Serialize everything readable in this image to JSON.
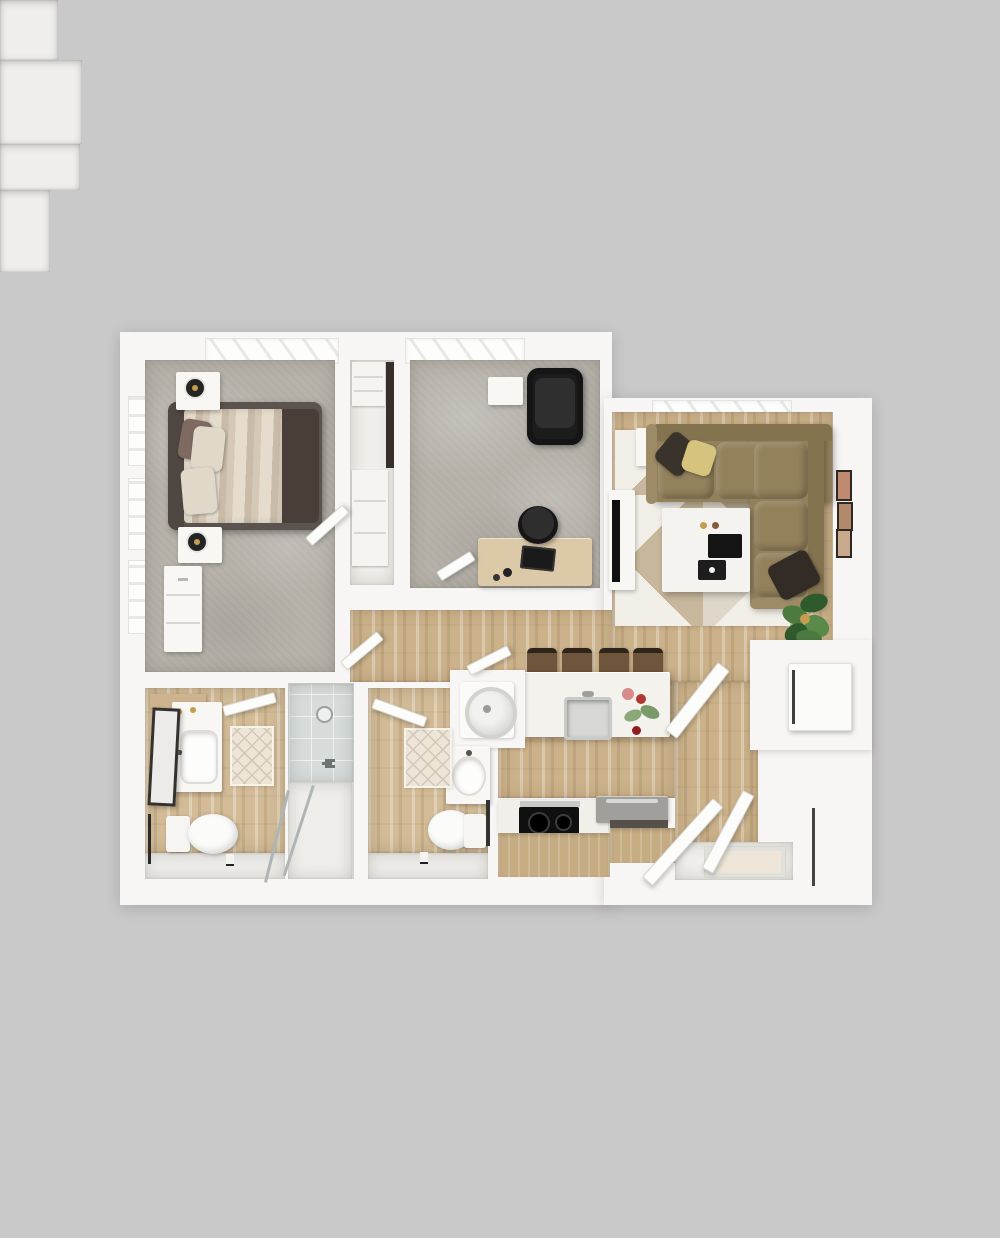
{
  "scene": {
    "type": "3d-floor-plan-top-view",
    "description": "Rendered top-down 3D floor plan of a one-bedroom apartment with den, two bathrooms, open kitchen-living area, laundry alcove and closets",
    "background_color": "#c9c9c9"
  },
  "palette": {
    "bg": "#c9c9c9",
    "wall": "#f7f6f4",
    "carpet": "#b7b3ab",
    "wood": "#ccb28a",
    "wood_bath": "#d2bb96",
    "tile": "#d7dcdb",
    "floor_white": "#efeeeb",
    "sofa": "#93815c",
    "sofa_light": "#9c8b66",
    "sofa_dark": "#84734f",
    "rug_base": "#ded6c8",
    "rug_light": "#f2efe8",
    "rug_tan": "#c7b79c",
    "rug_gray": "#b5a88f",
    "cabinet": "#c6ac83",
    "island": "#f4f2ed",
    "counter": "#f1efe9",
    "steel": "#c9cbc8",
    "black": "#1b1b1b",
    "bed_frame": "#5b534d",
    "bed_band": "#4a3f38",
    "duvet": "#e5dccd",
    "duvet_stripe": "#c9bba8",
    "pillow": "#e0d8c9",
    "pillow_accent": "#7e6a60",
    "desk_wood": "#dcc9a8",
    "stool": "#6f553b",
    "green": "#4c7a3f",
    "green_dark": "#2f5a2c",
    "gold": "#c59d4e",
    "mat": "#ece5d8",
    "mat_line": "#d4c9b8",
    "appliance_gray": "#a19f9b",
    "glass": "#aeb6b5"
  },
  "rooms": [
    {
      "id": "bedroom",
      "floor": "carpet"
    },
    {
      "id": "bedroom-closet",
      "floor": "white"
    },
    {
      "id": "office-den",
      "floor": "carpet"
    },
    {
      "id": "living-room",
      "floor": "wood"
    },
    {
      "id": "hallway",
      "floor": "wood"
    },
    {
      "id": "kitchen",
      "floor": "wood"
    },
    {
      "id": "bathroom-1",
      "floor": "wood"
    },
    {
      "id": "walk-in-shower",
      "floor": "tile"
    },
    {
      "id": "bathroom-2",
      "floor": "wood"
    },
    {
      "id": "laundry-alcove",
      "floor": "white"
    },
    {
      "id": "utility-closet",
      "floor": "white"
    },
    {
      "id": "linen-closet",
      "floor": "white"
    },
    {
      "id": "entry",
      "floor": "white"
    }
  ],
  "furniture": {
    "bedroom": [
      "queen-bed",
      "headboard",
      "striped-duvet",
      "pillows",
      "nightstand-top",
      "nightstand-bottom",
      "table-lamp-top",
      "table-lamp-bottom",
      "dresser"
    ],
    "bedroom_closet": [
      "shelf-unit-top",
      "shelf-unit-bottom",
      "hanging-clothes"
    ],
    "office_den": [
      "lounge-chair",
      "side-table",
      "desk",
      "laptop",
      "office-chair"
    ],
    "living_room": [
      "sectional-sofa",
      "throw-pillow-dark",
      "throw-pillow-yellow",
      "throw-pillow-chaise",
      "coffee-table",
      "serving-tray",
      "book",
      "tv-console",
      "tv",
      "area-rug",
      "side-table",
      "potted-plant",
      "wall-art-1",
      "wall-art-2",
      "wall-art-3"
    ],
    "kitchen": [
      "island",
      "bar-stool-1",
      "bar-stool-2",
      "bar-stool-3",
      "bar-stool-4",
      "undermount-sink",
      "faucet",
      "flower-arrangement",
      "cooktop",
      "range-oven",
      "base-cabinets"
    ],
    "bathroom_1": [
      "vanity",
      "sink",
      "leaning-mirror",
      "toilet",
      "bath-mat",
      "towel-bar",
      "toilet-paper-holder",
      "wall-shelf"
    ],
    "shower": [
      "shower-head",
      "shower-valve",
      "glass-door-panels"
    ],
    "bathroom_2": [
      "vanity",
      "sink",
      "toilet",
      "bath-mat",
      "towel-rack",
      "toilet-paper-holder"
    ],
    "laundry_alcove": [
      "washer"
    ],
    "utility_closet": [
      "utility-appliance"
    ],
    "entry": [
      "doormat",
      "entry-door-leaf-1",
      "entry-door-leaf-2"
    ]
  },
  "windows": {
    "bedroom_top": 1,
    "office_top": 1,
    "living_top": 1,
    "bedroom_left": 3
  },
  "doors": [
    "bedroom-door",
    "hall-door",
    "office-door",
    "bathroom-1-door",
    "bathroom-2-door",
    "laundry-door",
    "utility-closet-door",
    "entry-doors"
  ]
}
